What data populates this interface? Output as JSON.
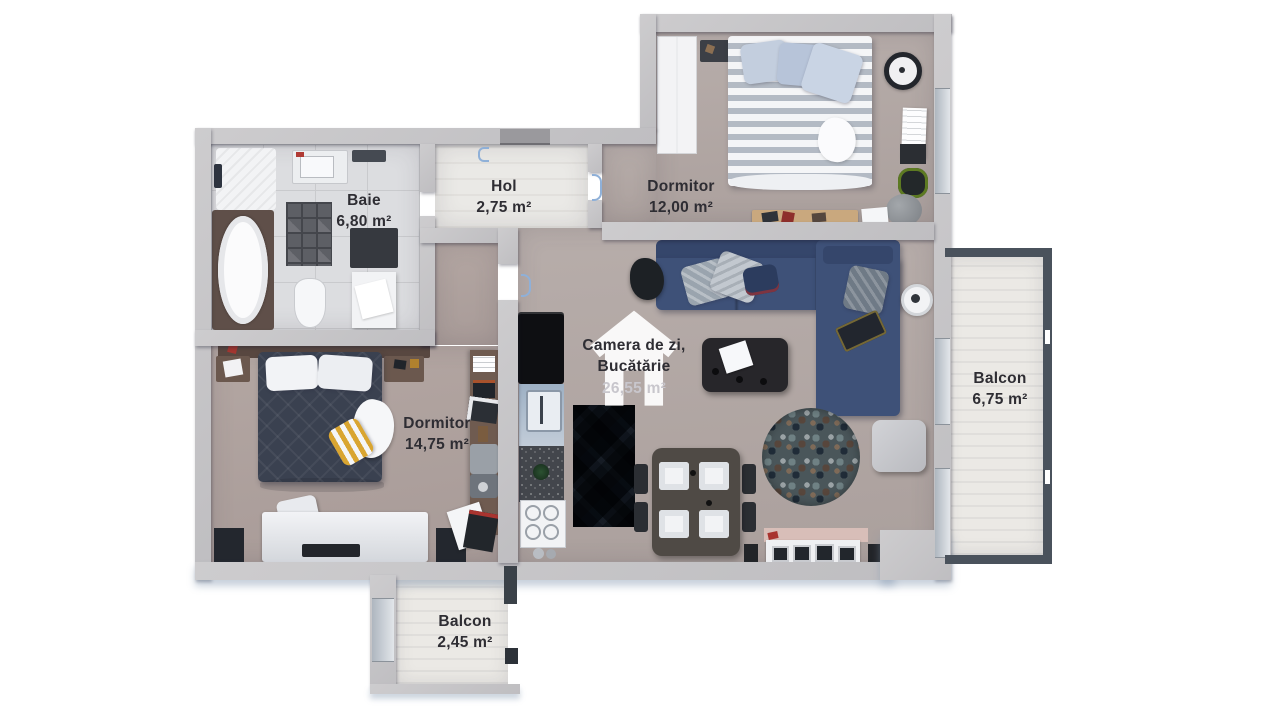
{
  "floor_plan": {
    "watermark": {
      "icon": "house-icon"
    },
    "rooms": {
      "baie": {
        "name": "Baie",
        "area": "6,80 m²"
      },
      "hol": {
        "name": "Hol",
        "area": "2,75 m²"
      },
      "dormitor_12": {
        "name": "Dormitor",
        "area": "12,00 m²"
      },
      "camera_de_zi": {
        "name_line1": "Camera de zi,",
        "name_line2": "Bucătărie",
        "area": "26,55 m²"
      },
      "dormitor_14": {
        "name": "Dormitor",
        "area": "14,75 m²"
      },
      "balcon_6": {
        "name": "Balcon",
        "area": "6,75 m²"
      },
      "balcon_2": {
        "name": "Balcon",
        "area": "2,45 m²"
      }
    },
    "colors": {
      "wall": "#c6c5c7",
      "floor_living": "#b2a8a5",
      "floor_bathroom": "#dcdde0",
      "floor_hall": "#e9e8e6",
      "floor_balcony": "#ebe9e5",
      "sofa": "#3e5178",
      "bed_dark": "#3a4150",
      "railing": "#4a525c",
      "label_text": "#2e2d33"
    }
  }
}
